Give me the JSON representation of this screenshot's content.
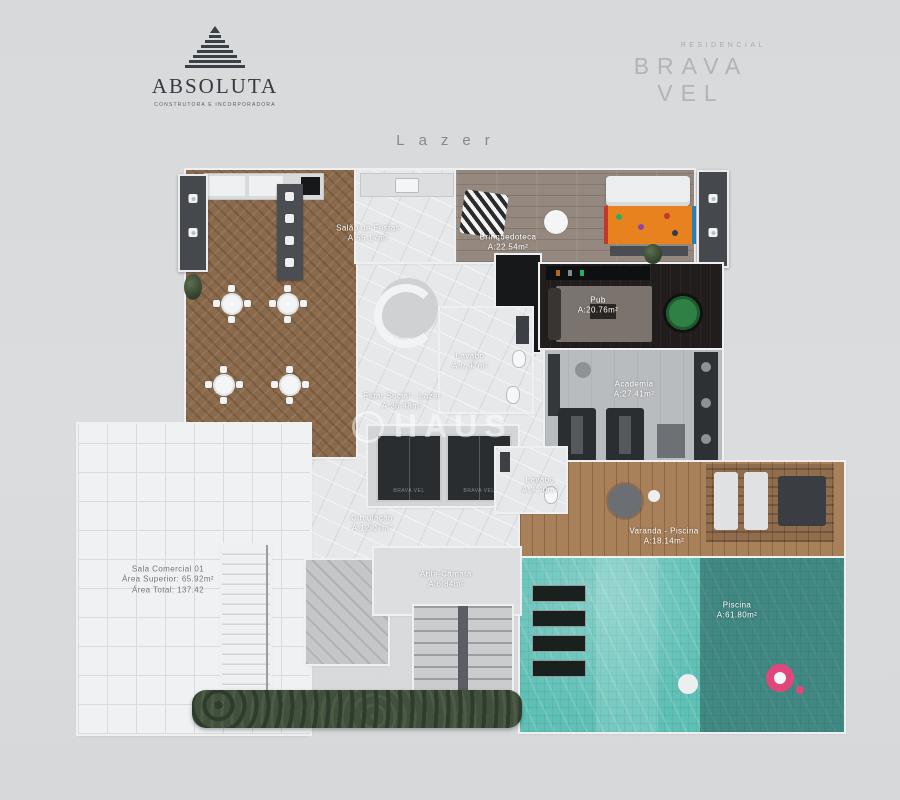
{
  "header": {
    "brand_left": {
      "name": "ABSOLUTA",
      "tagline": "CONSTRUTORA E INCORPORADORA"
    },
    "brand_right": {
      "category": "RESIDENCIAL",
      "name": "BRAVA VEL"
    }
  },
  "plan_title": "Lazer",
  "watermark_text": "HAUS",
  "elevator": {
    "door_text": "BRAVA VEL"
  },
  "rooms": {
    "salao": {
      "label": "Salão de Festas",
      "area": "A:55.17m²"
    },
    "brinquedoteca": {
      "label": "Brinquedoteca",
      "area": "A:22.54m²"
    },
    "pub": {
      "label": "Pub",
      "area": "A:20.76m²"
    },
    "lavabo1": {
      "label": "Lavabo",
      "area": "A:9.97m²"
    },
    "estar": {
      "label": "Estar Social - Lazer",
      "area": "A:26.48m²"
    },
    "academia": {
      "label": "Academia",
      "area": "A:27.41m²"
    },
    "lavabo2": {
      "label": "Lavabo",
      "area": "A:3.40m²"
    },
    "circulacao": {
      "label": "Circulação",
      "area": "A:12.07m²"
    },
    "antecamara": {
      "label": "Ante-Câmara",
      "area": "A:6.84m²"
    },
    "varanda": {
      "label": "Varanda - Piscina",
      "area": "A:18.14m²"
    },
    "piscina": {
      "label": "Piscina",
      "area": "A:61.80m²"
    },
    "sala_comercial": {
      "label": "Sala Comercial 01",
      "line2": "Área Superior: 65.92m²",
      "line3": "Área Total: 137.42"
    }
  },
  "colors": {
    "background": "#d8dadc",
    "brand_ink": "#363b41",
    "brand_gray": "#b1b5b8",
    "wood": "#8a6a4b",
    "gray_wood": "#95897f",
    "marble": "#e7e8ea",
    "pub_floor": "#211d1c",
    "gym_floor": "#b9bcbf",
    "deck": "#a8805a",
    "pool_light": "#5fc0b6",
    "pool_dark": "#3f6a66",
    "rug_orange": "#e8821e",
    "poker_green": "#2e8045",
    "hedge_green": "#41503d",
    "float_pink": "#e0487c"
  }
}
